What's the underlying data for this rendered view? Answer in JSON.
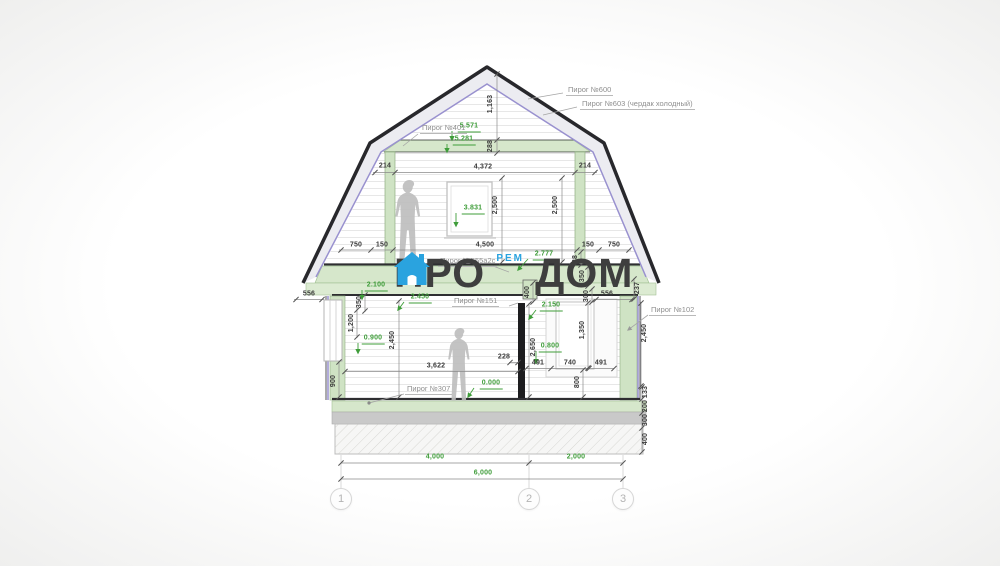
{
  "colors": {
    "dim_green": "#3f9d3a",
    "dim_black": "#3a3a3a",
    "accent_blue": "#2aa3df",
    "watermark_gray": "#3e3e3e",
    "band_green": "#d6e7cb",
    "roof_purple": "#9991cf"
  },
  "watermark": {
    "word_left": "ПРО",
    "word_right": "ДОМ",
    "sub_label": "РЕМ",
    "icon": "house-icon"
  },
  "axes": {
    "y": 499,
    "items": [
      {
        "label": "1",
        "x": 341
      },
      {
        "label": "2",
        "x": 529
      },
      {
        "label": "3",
        "x": 623
      }
    ]
  },
  "drawing": {
    "callouts": [
      {
        "text": "Пирог №600",
        "x": 566,
        "y": 96
      },
      {
        "text": "Пирог №603 (чердак холодный)",
        "x": 580,
        "y": 110
      },
      {
        "text": "Пирог №401",
        "x": 420,
        "y": 134
      },
      {
        "text": "Пирог №555а2с",
        "x": 438,
        "y": 267
      },
      {
        "text": "Пирог №151",
        "x": 452,
        "y": 307
      },
      {
        "text": "Пирог №102",
        "x": 649,
        "y": 316
      },
      {
        "text": "Пирог №307",
        "x": 405,
        "y": 395
      }
    ],
    "dims": [
      {
        "t": "5.571",
        "x": 469,
        "y": 128,
        "k": "level"
      },
      {
        "t": "5.281",
        "x": 464,
        "y": 141,
        "k": "level"
      },
      {
        "t": "3.831",
        "x": 473,
        "y": 210,
        "k": "level"
      },
      {
        "t": "2.777",
        "x": 544,
        "y": 256,
        "k": "level"
      },
      {
        "t": "2.100",
        "x": 376,
        "y": 287,
        "k": "level"
      },
      {
        "t": "2.450",
        "x": 420,
        "y": 299,
        "k": "level"
      },
      {
        "t": "2.150",
        "x": 551,
        "y": 307,
        "k": "level"
      },
      {
        "t": "0.900",
        "x": 373,
        "y": 340,
        "k": "level"
      },
      {
        "t": "0.800",
        "x": 550,
        "y": 348,
        "k": "level"
      },
      {
        "t": "0.000",
        "x": 491,
        "y": 385,
        "k": "level"
      },
      {
        "t": "4,000",
        "x": 435,
        "y": 458,
        "k": "glin"
      },
      {
        "t": "2,000",
        "x": 576,
        "y": 458,
        "k": "glin"
      },
      {
        "t": "6,000",
        "x": 483,
        "y": 474,
        "k": "glin"
      },
      {
        "t": "214",
        "x": 385,
        "y": 167,
        "k": "lin"
      },
      {
        "t": "4,372",
        "x": 483,
        "y": 168,
        "k": "lin"
      },
      {
        "t": "214",
        "x": 585,
        "y": 167,
        "k": "lin"
      },
      {
        "t": "750",
        "x": 356,
        "y": 246,
        "k": "lin"
      },
      {
        "t": "150",
        "x": 382,
        "y": 246,
        "k": "lin"
      },
      {
        "t": "4,500",
        "x": 485,
        "y": 246,
        "k": "lin"
      },
      {
        "t": "150",
        "x": 588,
        "y": 246,
        "k": "lin"
      },
      {
        "t": "750",
        "x": 614,
        "y": 246,
        "k": "lin"
      },
      {
        "t": "556",
        "x": 309,
        "y": 295,
        "k": "lin"
      },
      {
        "t": "556",
        "x": 607,
        "y": 295,
        "k": "lin"
      },
      {
        "t": "3,622",
        "x": 436,
        "y": 367,
        "k": "lin"
      },
      {
        "t": "228",
        "x": 504,
        "y": 358,
        "k": "lin"
      },
      {
        "t": "491",
        "x": 538,
        "y": 364,
        "k": "lin"
      },
      {
        "t": "740",
        "x": 570,
        "y": 364,
        "k": "lin"
      },
      {
        "t": "491",
        "x": 601,
        "y": 364,
        "k": "lin"
      },
      {
        "t": "1,163",
        "x": 491,
        "y": 104,
        "k": "lin",
        "r": 1
      },
      {
        "t": "288",
        "x": 491,
        "y": 146,
        "k": "lin",
        "r": 1
      },
      {
        "t": "2,500",
        "x": 496,
        "y": 205,
        "k": "lin",
        "r": 1
      },
      {
        "t": "2,500",
        "x": 556,
        "y": 205,
        "k": "lin",
        "r": 1
      },
      {
        "t": "88",
        "x": 576,
        "y": 259,
        "k": "lin",
        "r": 1
      },
      {
        "t": "350",
        "x": 583,
        "y": 276,
        "k": "lin",
        "r": 1
      },
      {
        "t": "350",
        "x": 360,
        "y": 302,
        "k": "lin",
        "r": 1
      },
      {
        "t": "237",
        "x": 638,
        "y": 288,
        "k": "lin",
        "r": 1
      },
      {
        "t": "300",
        "x": 587,
        "y": 296,
        "k": "lin",
        "r": 1
      },
      {
        "t": "400",
        "x": 528,
        "y": 292,
        "k": "lin",
        "r": 1
      },
      {
        "t": "1,200",
        "x": 352,
        "y": 323,
        "k": "lin",
        "r": 1
      },
      {
        "t": "2,450",
        "x": 393,
        "y": 340,
        "k": "lin",
        "r": 1
      },
      {
        "t": "2,650",
        "x": 534,
        "y": 347,
        "k": "lin",
        "r": 1
      },
      {
        "t": "1,350",
        "x": 583,
        "y": 330,
        "k": "lin",
        "r": 1
      },
      {
        "t": "900",
        "x": 334,
        "y": 381,
        "k": "lin",
        "r": 1
      },
      {
        "t": "800",
        "x": 578,
        "y": 382,
        "k": "lin",
        "r": 1
      },
      {
        "t": "2,450",
        "x": 645,
        "y": 333,
        "k": "lin",
        "r": 1
      },
      {
        "t": "133",
        "x": 646,
        "y": 392,
        "k": "lin",
        "r": 1
      },
      {
        "t": "200",
        "x": 646,
        "y": 406,
        "k": "lin",
        "r": 1
      },
      {
        "t": "300",
        "x": 646,
        "y": 420,
        "k": "lin",
        "r": 1
      },
      {
        "t": "400",
        "x": 646,
        "y": 439,
        "k": "lin",
        "r": 1
      }
    ],
    "dim_lines": [
      {
        "o": "h",
        "c": 172.5,
        "a": 373,
        "b": 597,
        "ticks": [
          375,
          395,
          575,
          595
        ]
      },
      {
        "o": "v",
        "c": 502,
        "a": 178,
        "b": 262,
        "ticks": [
          178,
          262
        ]
      },
      {
        "o": "v",
        "c": 562,
        "a": 178,
        "b": 262,
        "ticks": [
          178,
          262
        ]
      },
      {
        "o": "h",
        "c": 250,
        "a": 339,
        "b": 631,
        "ticks": [
          341,
          371,
          393,
          577,
          599,
          629
        ]
      },
      {
        "o": "v",
        "c": 497,
        "a": 74,
        "b": 140,
        "ticks": [
          74,
          140
        ]
      },
      {
        "o": "v",
        "c": 497,
        "a": 140,
        "b": 153,
        "ticks": [
          153
        ]
      },
      {
        "o": "h",
        "c": 299.5,
        "a": 294,
        "b": 324,
        "ticks": [
          296,
          322
        ]
      },
      {
        "o": "v",
        "c": 365,
        "a": 294,
        "b": 312,
        "ticks": [
          295,
          311
        ]
      },
      {
        "o": "h",
        "c": 299.5,
        "a": 594,
        "b": 634,
        "ticks": [
          596,
          632
        ]
      },
      {
        "o": "v",
        "c": 634,
        "a": 278,
        "b": 300,
        "ticks": [
          279,
          299
        ]
      },
      {
        "o": "v",
        "c": 581,
        "a": 251,
        "b": 266,
        "ticks": [
          252,
          265
        ]
      },
      {
        "o": "v",
        "c": 588,
        "a": 266,
        "b": 287,
        "ticks": [
          267,
          286
        ]
      },
      {
        "o": "v",
        "c": 357,
        "a": 308,
        "b": 338,
        "ticks": [
          310,
          337
        ]
      },
      {
        "o": "v",
        "c": 399,
        "a": 300,
        "b": 398,
        "ticks": [
          301,
          397
        ]
      },
      {
        "o": "v",
        "c": 339,
        "a": 361,
        "b": 398,
        "ticks": [
          362,
          397
        ]
      },
      {
        "o": "h",
        "c": 371.5,
        "a": 345,
        "b": 518,
        "ticks": [
          345,
          518
        ]
      },
      {
        "o": "h",
        "c": 362.5,
        "a": 509,
        "b": 519,
        "ticks": [
          510,
          518
        ]
      },
      {
        "o": "v",
        "c": 529,
        "a": 303,
        "b": 398,
        "ticks": [
          304,
          397
        ]
      },
      {
        "o": "v",
        "c": 533,
        "a": 282,
        "b": 303,
        "ticks": [
          283,
          302
        ]
      },
      {
        "o": "h",
        "c": 368.5,
        "a": 526,
        "b": 614,
        "ticks": [
          526,
          551,
          589,
          614
        ]
      },
      {
        "o": "v",
        "c": 583,
        "a": 369,
        "b": 398,
        "ticks": [
          370,
          397
        ]
      },
      {
        "o": "v",
        "c": 588,
        "a": 302,
        "b": 369,
        "ticks": [
          303,
          368
        ]
      },
      {
        "o": "v",
        "c": 592,
        "a": 288,
        "b": 303,
        "ticks": [
          289,
          302
        ]
      },
      {
        "o": "v",
        "c": 641,
        "a": 302,
        "b": 387,
        "ticks": [
          303,
          386
        ]
      },
      {
        "o": "v",
        "c": 642,
        "a": 387,
        "b": 452,
        "ticks": [
          387,
          399,
          413,
          428,
          452
        ]
      },
      {
        "o": "h",
        "c": 463,
        "a": 341,
        "b": 623,
        "ticks": [
          341,
          529,
          623
        ]
      },
      {
        "o": "h",
        "c": 479,
        "a": 341,
        "b": 623,
        "ticks": [
          341,
          623
        ]
      }
    ],
    "leaders": [
      {
        "p": [
          [
            528,
            99
          ],
          [
            563,
            93
          ]
        ]
      },
      {
        "p": [
          [
            543,
            115
          ],
          [
            577,
            107
          ]
        ]
      },
      {
        "p": [
          [
            418,
            134
          ],
          [
            403,
            146
          ]
        ]
      },
      {
        "p": [
          [
            493,
            266
          ],
          [
            509,
            272
          ]
        ]
      },
      {
        "p": [
          [
            509,
            306
          ],
          [
            518,
            303
          ]
        ]
      },
      {
        "p": [
          [
            648,
            315
          ],
          [
            628,
            330
          ]
        ],
        "end": "arrow"
      },
      {
        "p": [
          [
            404,
            394
          ],
          [
            369,
            403
          ]
        ],
        "end": "dot"
      }
    ],
    "level_arrows": [
      [
        452,
        131,
        452,
        140
      ],
      [
        447,
        144,
        447,
        152
      ],
      [
        456,
        213,
        456,
        226
      ],
      [
        528,
        259,
        518,
        270
      ],
      [
        362,
        290,
        362,
        299
      ],
      [
        404,
        302,
        398,
        310
      ],
      [
        536,
        310,
        529,
        319
      ],
      [
        358,
        343,
        358,
        353
      ],
      [
        536,
        351,
        536,
        363
      ],
      [
        474,
        388,
        468,
        397
      ]
    ]
  }
}
